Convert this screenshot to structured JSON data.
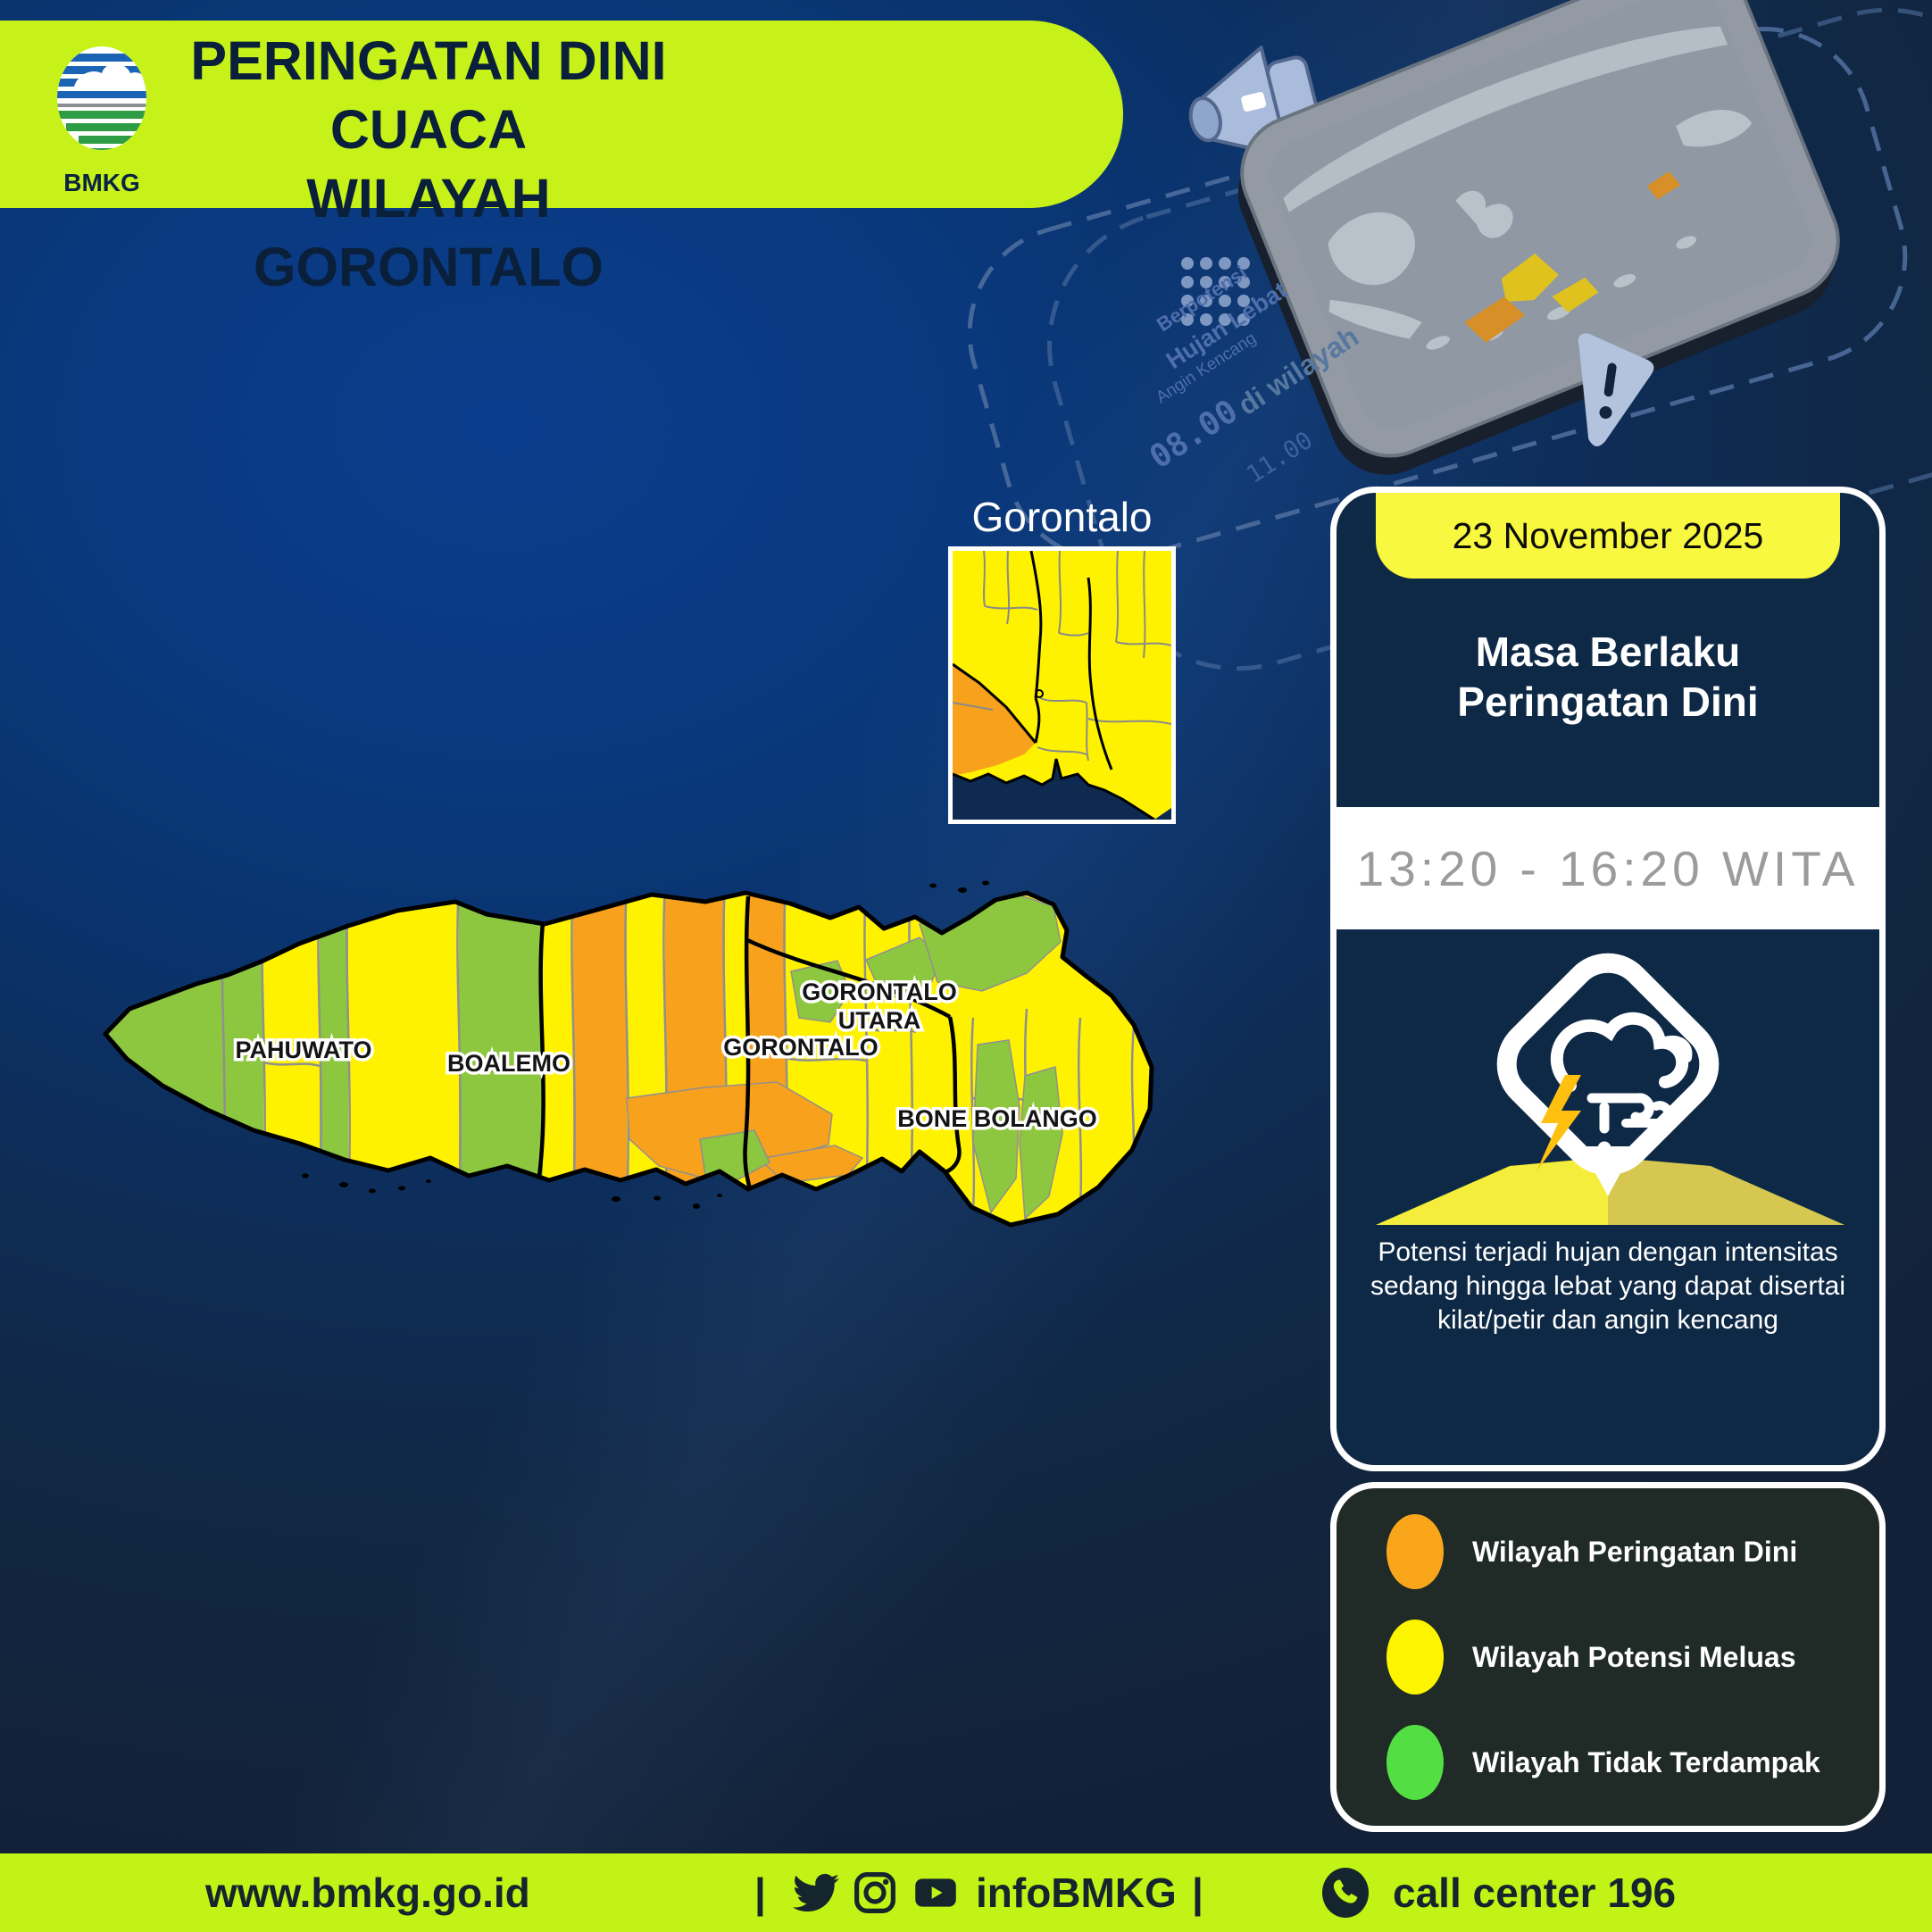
{
  "header": {
    "title_line1": "PERINGATAN DINI CUACA",
    "title_line2": "WILAYAH GORONTALO",
    "logo_text": "BMKG",
    "banner_color": "#C6F21A",
    "title_color": "#0A1F3A"
  },
  "illustration": {
    "texts": {
      "t1": "Berpotensi",
      "t2": "Hujan Lebat",
      "t3": "Angin Kencang",
      "t4": "di wilayah",
      "t5": "08.00",
      "t6": "11.00"
    },
    "icons": [
      "megaphone-icon",
      "smartphone-map-icon",
      "warning-pointer-icon",
      "dot-grid"
    ]
  },
  "inset": {
    "title": "Gorontalo"
  },
  "map": {
    "labels": {
      "pahuwato": "PAHUWATO",
      "boalemo": "BOALEMO",
      "gorontalo": "GORONTALO",
      "gorontalo_utara_line1": "GORONTALO",
      "gorontalo_utara_line2": "UTARA",
      "bone_bolango": "BONE BOLANGO"
    },
    "colors": {
      "warning": "#F7A11C",
      "potential": "#FFF200",
      "unaffected": "#8DC63F",
      "outline": "#000000",
      "district_border": "#909090"
    }
  },
  "card": {
    "date": "23 November 2025",
    "validity_line1": "Masa Berlaku",
    "validity_line2": "Peringatan Dini",
    "time_range": "13:20 - 16:20 WITA",
    "description": "Potensi terjadi hujan dengan intensitas sedang hingga lebat yang dapat disertai kilat/petir dan angin kencang",
    "weather_icon": "storm-rain-wind-icon",
    "accent_yellow": "#F9F840"
  },
  "legend": {
    "items": [
      {
        "label": "Wilayah Peringatan Dini",
        "color": "#F9A61A"
      },
      {
        "label": "Wilayah Potensi Meluas",
        "color": "#FDF500"
      },
      {
        "label": "Wilayah Tidak Terdampak",
        "color": "#53DF43"
      }
    ]
  },
  "footer": {
    "website": "www.bmkg.go.id",
    "separator1": "|",
    "social_handle": "infoBMKG",
    "separator2": "|",
    "call_center": "call center 196",
    "bar_color": "#C2F316"
  }
}
